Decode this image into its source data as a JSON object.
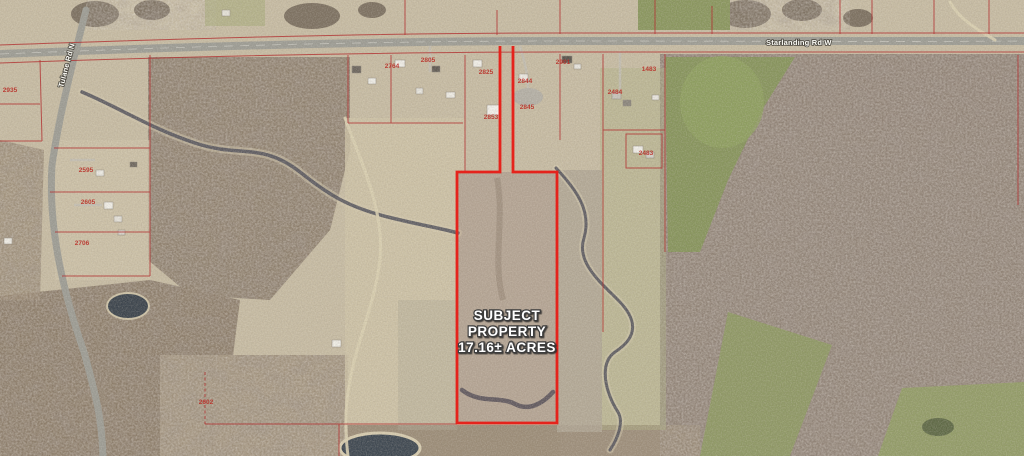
{
  "map": {
    "type": "aerial-parcel-map",
    "subject_property": {
      "label_lines": [
        "SUBJECT",
        "PROPERTY",
        "17.16± ACRES"
      ],
      "acres": "17.16±",
      "boundary_color": "#e5231c",
      "shape": "flag-lot: narrow access strip from road on north to large rectangular parcel"
    },
    "roads": [
      {
        "name": "Starlanding Rd W",
        "orientation": "horizontal"
      },
      {
        "name": "Tulane Rd N",
        "orientation": "vertical"
      }
    ],
    "colors": {
      "parcel_line": "#b23232",
      "subject_boundary": "#e5231c",
      "label_text": "#ffffff",
      "parcel_number_text": "#b92d26"
    },
    "parcel_labels": [
      {
        "text": "2935",
        "x": 10,
        "y": 92
      },
      {
        "text": "2595",
        "x": 86,
        "y": 172
      },
      {
        "text": "2605",
        "x": 88,
        "y": 204
      },
      {
        "text": "2706",
        "x": 82,
        "y": 245
      },
      {
        "text": "2602",
        "x": 206,
        "y": 404
      },
      {
        "text": "2764",
        "x": 392,
        "y": 68
      },
      {
        "text": "2805",
        "x": 428,
        "y": 62
      },
      {
        "text": "2825",
        "x": 486,
        "y": 74
      },
      {
        "text": "2853",
        "x": 491,
        "y": 119
      },
      {
        "text": "2844",
        "x": 525,
        "y": 83
      },
      {
        "text": "2845",
        "x": 527,
        "y": 109
      },
      {
        "text": "2901",
        "x": 563,
        "y": 64
      },
      {
        "text": "1483",
        "x": 649,
        "y": 71
      },
      {
        "text": "2484",
        "x": 615,
        "y": 94
      },
      {
        "text": "2483",
        "x": 646,
        "y": 155
      }
    ]
  }
}
